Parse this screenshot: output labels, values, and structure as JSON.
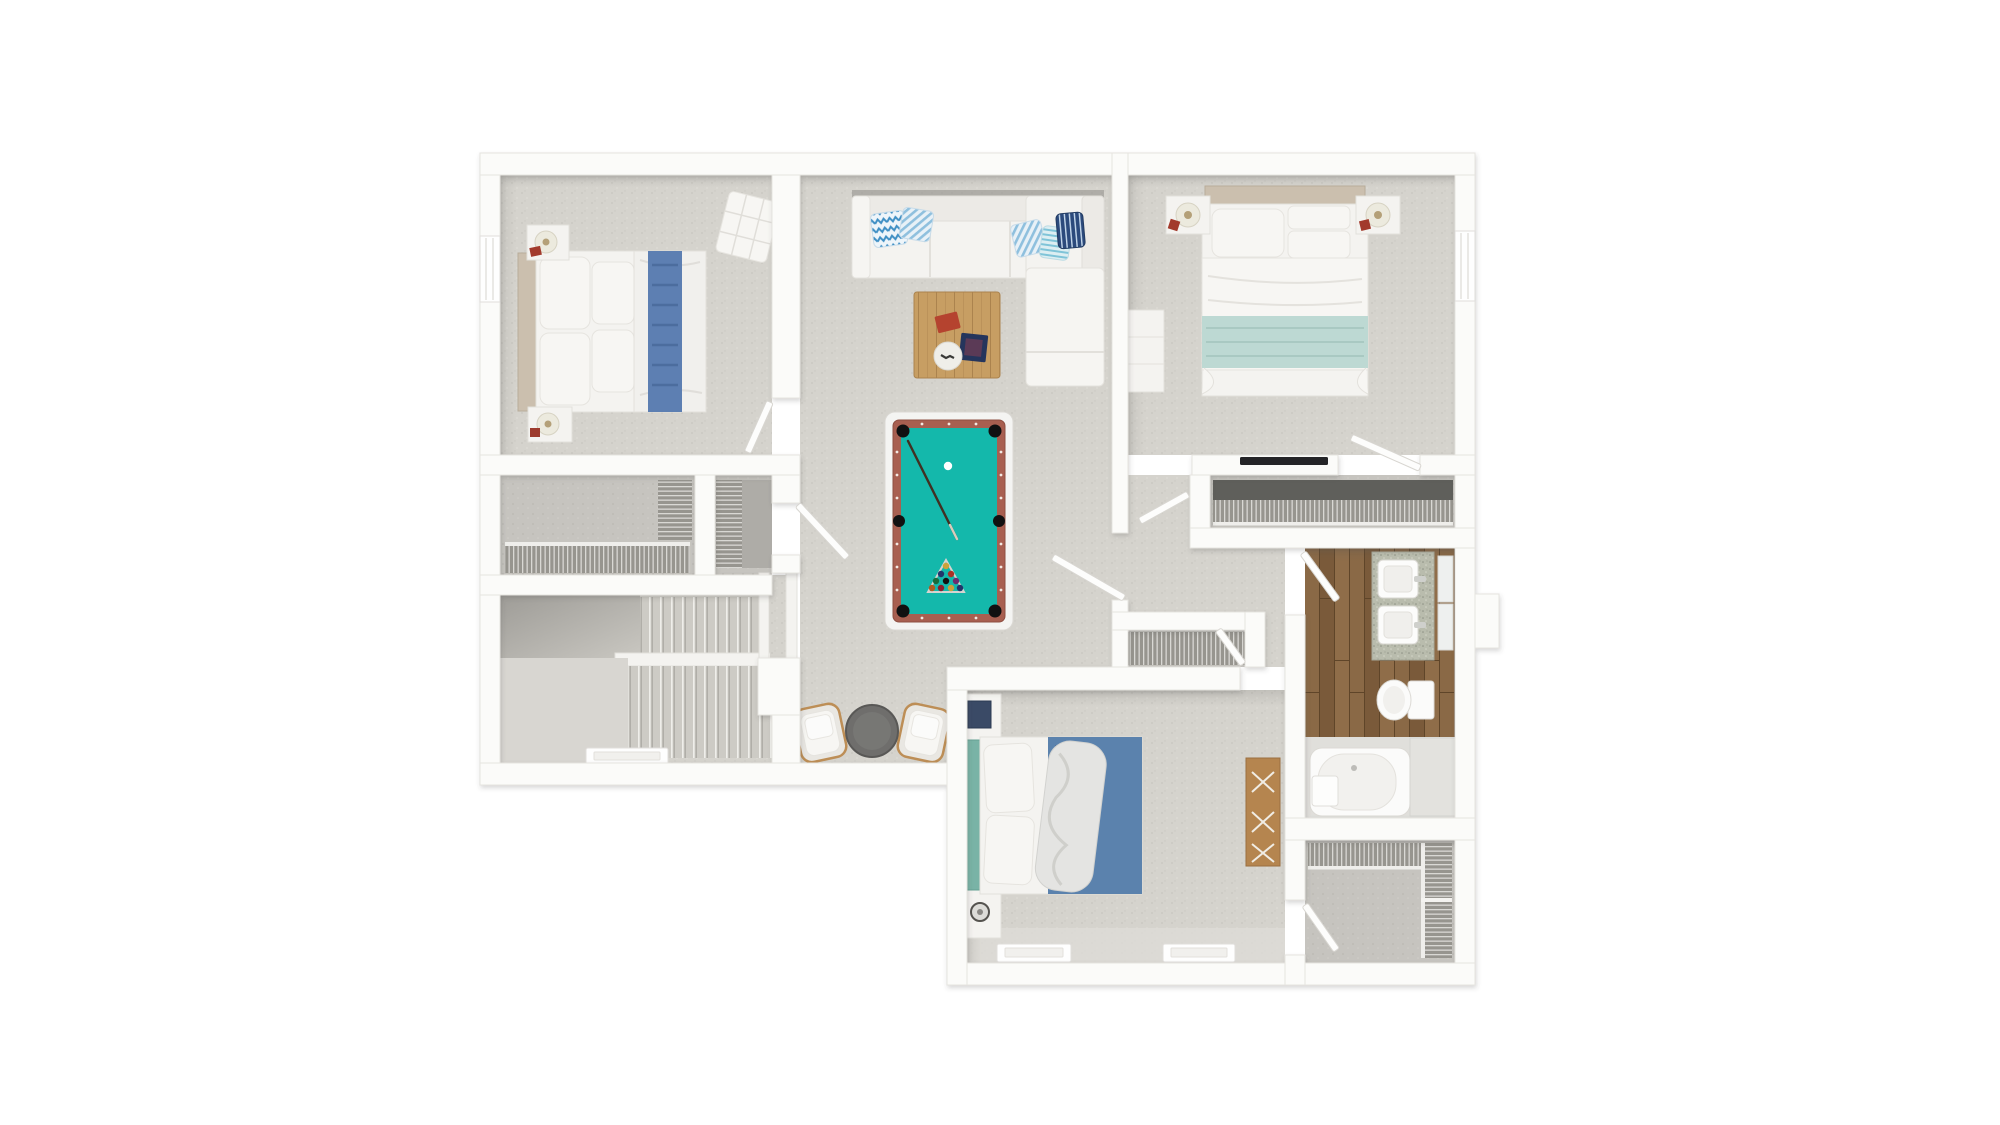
{
  "scene": {
    "type": "3d-floor-plan-top-down-render",
    "description": "Overhead 3D rendering of an upper residential floor with three bedrooms, a central game/living area with pool table, a bathroom, closets and a staircase",
    "rooms": [
      {
        "name": "bedroom-top-left",
        "furniture": [
          "double-bed-blue-throw",
          "nightstand-with-lamp",
          "nightstand-with-lamp",
          "tufted-bench"
        ]
      },
      {
        "name": "living-game-area",
        "furniture": [
          "l-shaped-white-sectional",
          "accent-pillows",
          "wood-coffee-table",
          "pool-table",
          "two-armchairs",
          "round-side-table"
        ]
      },
      {
        "name": "bedroom-top-right-master",
        "furniture": [
          "double-bed-seafoam-throw",
          "nightstand-with-lamp",
          "nightstand-with-lamp",
          "white-dresser",
          "wall-tv"
        ]
      },
      {
        "name": "master-closet",
        "furniture": [
          "wire-shelving"
        ]
      },
      {
        "name": "hallway",
        "furniture": [
          "linen-closet-wire-shelving"
        ]
      },
      {
        "name": "bathroom",
        "furniture": [
          "double-sink-granite-vanity",
          "two-mirrors",
          "toilet",
          "bathtub",
          "platform"
        ]
      },
      {
        "name": "bedroom-bottom",
        "furniture": [
          "double-bed-blue-blanket",
          "nightstand-radio",
          "nightstand-headphones",
          "wood-dresser"
        ]
      },
      {
        "name": "walk-in-closet",
        "furniture": [
          "wire-shelving"
        ]
      },
      {
        "name": "stairwell",
        "furniture": [
          "two-stair-flights",
          "handrail"
        ]
      },
      {
        "name": "hall-closet-a",
        "furniture": [
          "wire-shelving"
        ]
      },
      {
        "name": "hall-closet-b",
        "furniture": [
          "wire-shelving"
        ]
      }
    ],
    "door_count": 9,
    "window_count": 5
  },
  "colors": {
    "wall": "#fbfbf9",
    "wall-stroke": "#e6e4e0",
    "door": "#fdfdfc",
    "carpet": "#d5d3cd",
    "carpet-dark": "#c6c4bf",
    "white-furn": "#f4f3f0",
    "felt": "#14b8ab",
    "rail": "#a85f50",
    "wood-floor": "#83613f",
    "coffee-wood": "#c79e63",
    "dresser-wood": "#b5854f",
    "headboard-tan": "#cbbfae",
    "headboard-teal": "#79b3a6",
    "throw-blue": "#5d7fb2",
    "blanket-blue": "#5b82ad",
    "seafoam": "#bdd9d3",
    "chevron-blue": "#3f8fc4",
    "navy": "#2c4a7c",
    "granite": "#b9bcad",
    "table-gray": "#6f6e6c",
    "tv-black": "#242427",
    "book-red": "#b5432f",
    "tray-navy": "#25355c"
  }
}
